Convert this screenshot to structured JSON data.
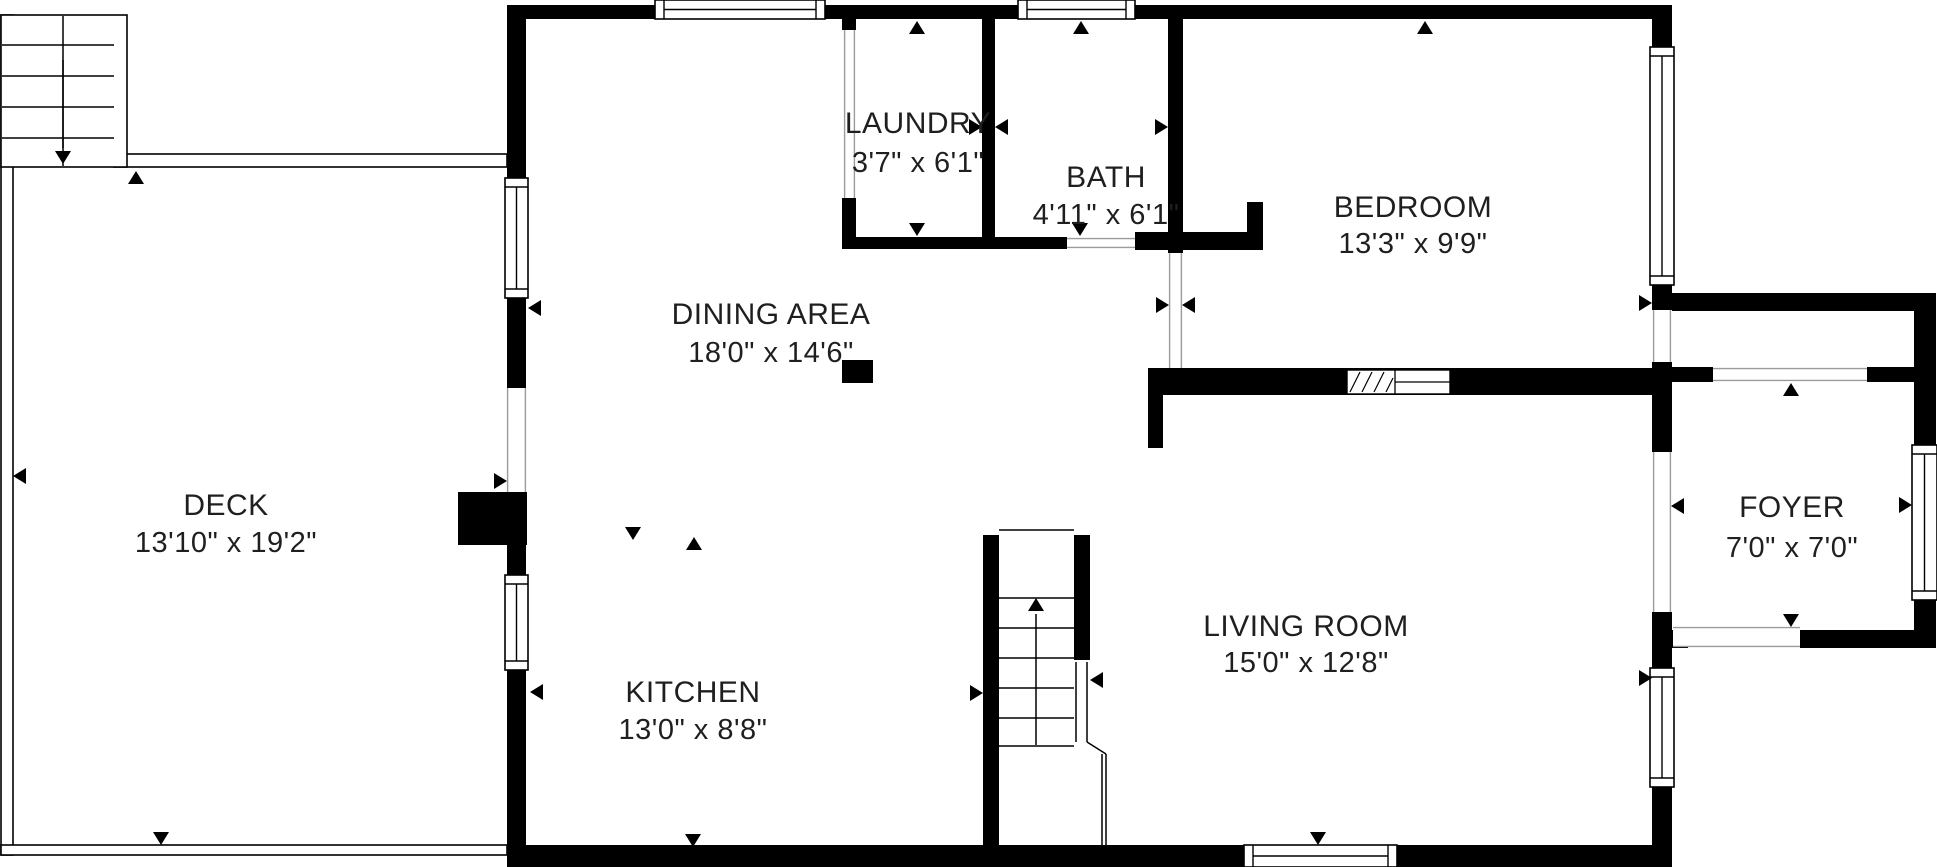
{
  "plan": {
    "canvas": {
      "width": 1937,
      "height": 867,
      "bg_color": "#ffffff",
      "wall_color": "#000000",
      "line_color": "#000000",
      "jamb_color": "#9b9b9b",
      "text_color": "#1f1f1f"
    },
    "rooms": [
      {
        "name": "LAUNDRY",
        "dims": "3'7\" x 6'1\"",
        "x": 918,
        "y": 133,
        "y2": 172
      },
      {
        "name": "BATH",
        "dims": "4'11\" x 6'1\"",
        "x": 1106,
        "y": 187,
        "y2": 224
      },
      {
        "name": "BEDROOM",
        "dims": "13'3\" x 9'9\"",
        "x": 1413,
        "y": 217,
        "y2": 253
      },
      {
        "name": "DINING AREA",
        "dims": "18'0\" x 14'6\"",
        "x": 771,
        "y": 324,
        "y2": 362
      },
      {
        "name": "DECK",
        "dims": "13'10\" x 19'2\"",
        "x": 226,
        "y": 515,
        "y2": 552
      },
      {
        "name": "KITCHEN",
        "dims": "13'0\" x 8'8\"",
        "x": 693,
        "y": 702,
        "y2": 739
      },
      {
        "name": "LIVING ROOM",
        "dims": "15'0\" x 12'8\"",
        "x": 1306,
        "y": 636,
        "y2": 672
      },
      {
        "name": "FOYER",
        "dims": "7'0\" x 7'0\"",
        "x": 1792,
        "y": 517,
        "y2": 557
      }
    ],
    "wall_rects": [
      [
        507,
        5,
        1165,
        14
      ],
      [
        507,
        19,
        19,
        159
      ],
      [
        507,
        298,
        19,
        90
      ],
      [
        458,
        492,
        69,
        53
      ],
      [
        507,
        492,
        19,
        83
      ],
      [
        507,
        670,
        19,
        175
      ],
      [
        507,
        845,
        1165,
        22
      ],
      [
        1652,
        5,
        20,
        42
      ],
      [
        1652,
        285,
        20,
        25
      ],
      [
        1652,
        362,
        20,
        90
      ],
      [
        1652,
        612,
        20,
        56
      ],
      [
        1652,
        630,
        36,
        18
      ],
      [
        1652,
        787,
        20,
        58
      ],
      [
        842,
        19,
        14,
        11
      ],
      [
        842,
        198,
        14,
        51
      ],
      [
        842,
        237,
        225,
        12
      ],
      [
        982,
        19,
        13,
        230
      ],
      [
        1135,
        232,
        128,
        18
      ],
      [
        1247,
        202,
        16,
        30
      ],
      [
        1168,
        19,
        15,
        234
      ],
      [
        1148,
        368,
        524,
        27
      ],
      [
        1148,
        395,
        15,
        53
      ],
      [
        983,
        535,
        16,
        310
      ],
      [
        1074,
        535,
        16,
        125
      ],
      [
        1672,
        293,
        264,
        18
      ],
      [
        1914,
        311,
        22,
        134
      ],
      [
        1914,
        600,
        22,
        48
      ],
      [
        1800,
        630,
        136,
        18
      ],
      [
        1672,
        367,
        41,
        15
      ],
      [
        1867,
        367,
        47,
        15
      ],
      [
        842,
        360,
        31,
        23
      ]
    ],
    "windows": [
      {
        "r": [
          655,
          0,
          170,
          19
        ],
        "o": "h"
      },
      {
        "r": [
          1018,
          0,
          117,
          19
        ],
        "o": "h"
      },
      {
        "r": [
          505,
          178,
          23,
          120
        ],
        "o": "v"
      },
      {
        "r": [
          505,
          575,
          23,
          95
        ],
        "o": "v"
      },
      {
        "r": [
          1650,
          47,
          24,
          238
        ],
        "o": "v"
      },
      {
        "r": [
          1912,
          445,
          25,
          155
        ],
        "o": "v"
      },
      {
        "r": [
          1650,
          668,
          24,
          119
        ],
        "o": "v"
      },
      {
        "r": [
          1244,
          845,
          153,
          22
        ],
        "o": "h"
      }
    ],
    "openings": [
      {
        "r": [
          507,
          388,
          19,
          104
        ],
        "o": "v"
      },
      {
        "r": [
          844,
          30,
          11,
          168
        ],
        "o": "v"
      },
      {
        "r": [
          1067,
          238,
          68,
          10
        ],
        "o": "h"
      },
      {
        "r": [
          1169,
          253,
          13,
          115
        ],
        "o": "v"
      },
      {
        "r": [
          1713,
          368,
          154,
          13
        ],
        "o": "h"
      },
      {
        "r": [
          1673,
          627,
          127,
          20
        ],
        "o": "h"
      },
      {
        "r": [
          1653,
          452,
          18,
          160
        ],
        "o": "v"
      },
      {
        "r": [
          1653,
          310,
          18,
          52
        ],
        "o": "v"
      }
    ],
    "pocket_door": {
      "r": [
        1347,
        370,
        103,
        24
      ],
      "divider_x": 1395,
      "hatch": [
        [
          1350,
          392,
          1360,
          372
        ],
        [
          1362,
          392,
          1372,
          372
        ],
        [
          1374,
          392,
          1384,
          372
        ],
        [
          1386,
          392,
          1393,
          378
        ]
      ]
    },
    "outline_rects": [
      [
        1,
        15,
        12,
        840
      ],
      [
        1,
        845,
        506,
        10
      ],
      [
        114,
        154,
        393,
        13
      ],
      [
        1,
        15,
        126,
        152
      ]
    ],
    "lines": [
      [
        63,
        16,
        63,
        166
      ],
      [
        2,
        45,
        114,
        45
      ],
      [
        2,
        76,
        114,
        76
      ],
      [
        2,
        107,
        114,
        107
      ],
      [
        2,
        138,
        114,
        138
      ],
      [
        63,
        60,
        63,
        148
      ],
      [
        999,
        530,
        1074,
        530
      ],
      [
        999,
        598,
        1074,
        598
      ],
      [
        999,
        628,
        1074,
        628
      ],
      [
        999,
        658,
        1074,
        658
      ],
      [
        999,
        688,
        1074,
        688
      ],
      [
        999,
        718,
        1074,
        718
      ],
      [
        999,
        746,
        1074,
        746
      ],
      [
        1076,
        662,
        1076,
        742
      ],
      [
        1087,
        662,
        1087,
        742
      ],
      [
        1087,
        742,
        1106,
        754
      ],
      [
        1102,
        754,
        1102,
        845
      ],
      [
        1106,
        754,
        1106,
        845
      ],
      [
        1036,
        745,
        1036,
        614
      ]
    ],
    "arrows": [
      {
        "x": 136,
        "y": 171,
        "dir": "up"
      },
      {
        "x": 161,
        "y": 845,
        "dir": "down"
      },
      {
        "x": 13,
        "y": 476,
        "dir": "left"
      },
      {
        "x": 507,
        "y": 481,
        "dir": "right"
      },
      {
        "x": 528,
        "y": 308,
        "dir": "left"
      },
      {
        "x": 530,
        "y": 692,
        "dir": "left"
      },
      {
        "x": 917,
        "y": 21,
        "dir": "up"
      },
      {
        "x": 917,
        "y": 236,
        "dir": "down"
      },
      {
        "x": 982,
        "y": 127,
        "dir": "right"
      },
      {
        "x": 995,
        "y": 127,
        "dir": "left"
      },
      {
        "x": 1081,
        "y": 21,
        "dir": "up"
      },
      {
        "x": 1080,
        "y": 236,
        "dir": "down"
      },
      {
        "x": 1168,
        "y": 127,
        "dir": "right"
      },
      {
        "x": 1425,
        "y": 21,
        "dir": "up"
      },
      {
        "x": 1169,
        "y": 305,
        "dir": "right"
      },
      {
        "x": 1182,
        "y": 305,
        "dir": "left"
      },
      {
        "x": 1652,
        "y": 303,
        "dir": "right"
      },
      {
        "x": 983,
        "y": 693,
        "dir": "right"
      },
      {
        "x": 1090,
        "y": 680,
        "dir": "left"
      },
      {
        "x": 693,
        "y": 847,
        "dir": "down"
      },
      {
        "x": 1318,
        "y": 845,
        "dir": "down"
      },
      {
        "x": 1652,
        "y": 678,
        "dir": "right"
      },
      {
        "x": 1671,
        "y": 506,
        "dir": "left"
      },
      {
        "x": 1912,
        "y": 505,
        "dir": "right"
      },
      {
        "x": 1791,
        "y": 383,
        "dir": "up"
      },
      {
        "x": 1791,
        "y": 627,
        "dir": "down"
      },
      {
        "x": 633,
        "y": 540,
        "dir": "down"
      },
      {
        "x": 694,
        "y": 537,
        "dir": "up"
      },
      {
        "x": 63,
        "y": 164,
        "dir": "down"
      },
      {
        "x": 1036,
        "y": 598,
        "dir": "up"
      }
    ]
  }
}
